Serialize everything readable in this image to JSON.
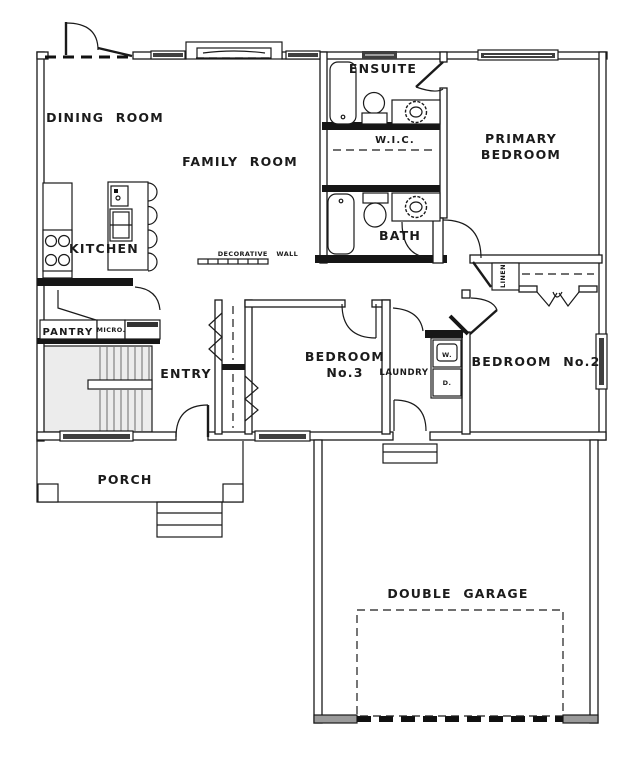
{
  "title": "Single storey floor plan",
  "colors": {
    "line": "#1a1a1a",
    "glass": "#3f3f3f",
    "stair_fill": "#ececec",
    "background": "#ffffff"
  },
  "rooms": {
    "dining": {
      "label": "DINING ROOM"
    },
    "family": {
      "label": "FAMILY ROOM"
    },
    "kitchen": {
      "label": "KITCHEN"
    },
    "ensuite": {
      "label": "ENSUITE"
    },
    "wic": {
      "label": "W.I.C."
    },
    "bath": {
      "label": "BATH"
    },
    "primary": {
      "line1": "PRIMARY",
      "line2": "BEDROOM"
    },
    "bedroom3": {
      "line1": "BEDROOM",
      "line2": "No.3"
    },
    "bedroom2": {
      "label": "BEDROOM No.2"
    },
    "laundry": {
      "label": "LAUNDRY"
    },
    "entry": {
      "label": "ENTRY"
    },
    "pantry": {
      "label": "PANTRY"
    },
    "micro": {
      "label": "MICRO."
    },
    "linen": {
      "label": "LINEN"
    },
    "porch": {
      "label": "PORCH"
    },
    "garage": {
      "label": "DOUBLE GARAGE"
    },
    "decorative_wall": {
      "label": "DECORATIVE WALL"
    },
    "washer": {
      "label": "W."
    },
    "dryer": {
      "label": "D."
    }
  }
}
